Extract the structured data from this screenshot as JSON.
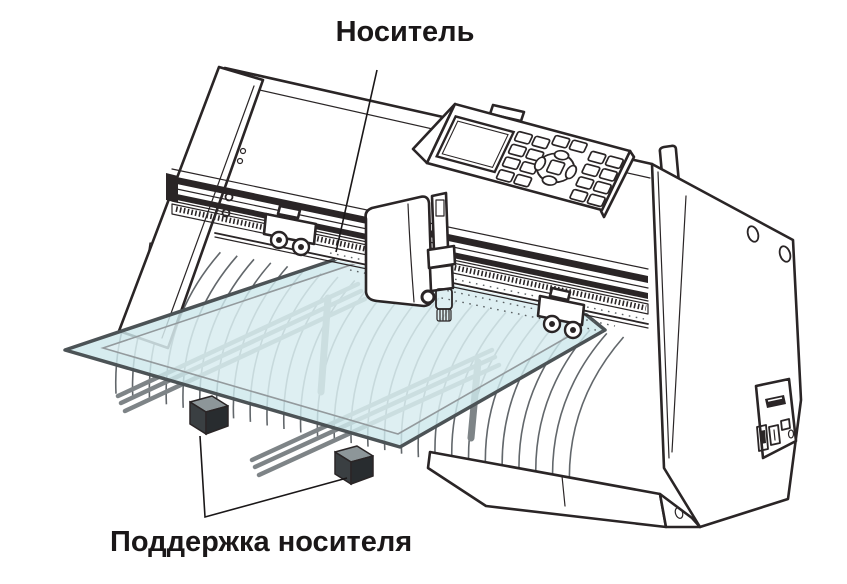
{
  "figure": {
    "kind": "technical-illustration",
    "subject": "cutting-plotter-with-sheet-media-loaded",
    "labels": {
      "media": "Носитель",
      "media_support": "Поддержка носителя"
    }
  },
  "colors": {
    "background": "#ffffff",
    "outline": "#2a2526",
    "text": "#1a1718",
    "media_fill": "#cde8ec",
    "media_edge": "#4c5356",
    "support_arm": "#7e8487",
    "support_leg": "#3a3f42",
    "rib_gray": "#62676b"
  }
}
